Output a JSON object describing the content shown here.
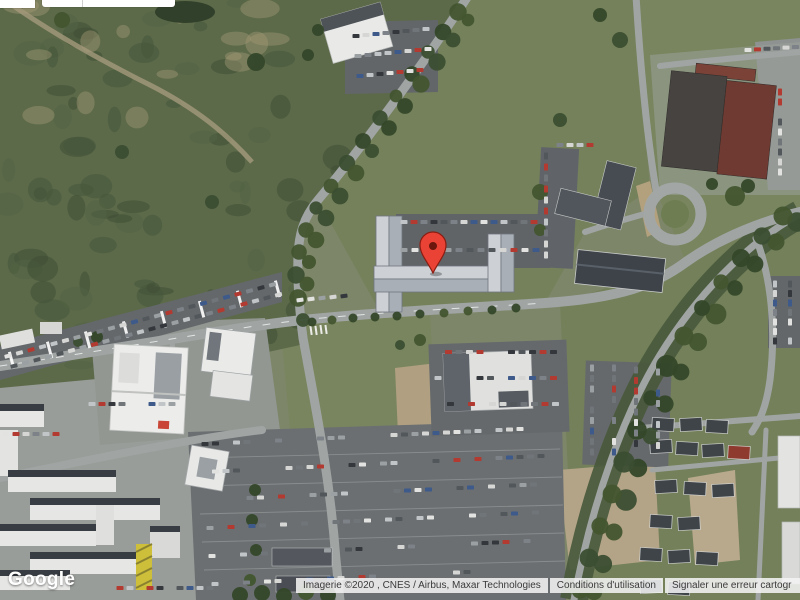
{
  "map": {
    "view": "satellite",
    "marker": {
      "name": "red-location-pin",
      "color": "#EA4335",
      "outline": "#8a1d12",
      "dot": "#6b170e"
    }
  },
  "branding": {
    "logo_text": "Google"
  },
  "attribution": {
    "imagery_credit": "Imagerie ©2020 , CNES / Airbus, Maxar Technologies",
    "terms_link": "Conditions d'utilisation",
    "report_link": "Signaler une erreur cartogr"
  },
  "colors": {
    "attribution_bg": "#f3f3f3",
    "attribution_text": "#3a3a3a",
    "terrain_base": "#7e8669",
    "scrub_green": "#5c6a4a",
    "road_gray": "#a0a5a4"
  }
}
